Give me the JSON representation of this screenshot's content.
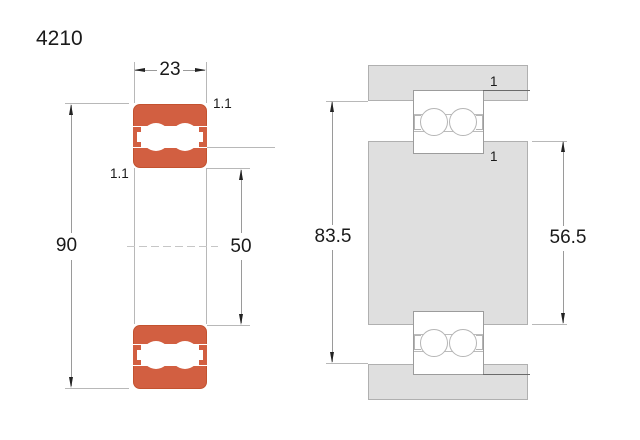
{
  "title": "4210",
  "left_view": {
    "width": "23",
    "outer_diameter": "90",
    "bore_diameter": "50",
    "chamfer_top": "1.1",
    "chamfer_bottom": "1.1"
  },
  "right_view": {
    "housing_abutment_diameter": "83.5",
    "shaft_abutment_diameter": "56.5",
    "fillet_top": "1",
    "fillet_bottom": "1"
  },
  "colors": {
    "bearing_ring_orange": "#d25f41",
    "mounting_steel_gray": "#dfdfdf"
  }
}
